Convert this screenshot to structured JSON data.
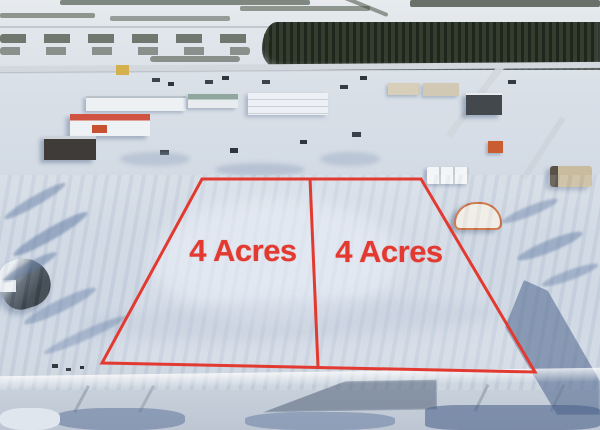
{
  "scene": {
    "type": "aerial-winter-photo",
    "description": "Drone photo of snowy rural industrial town with two marked land parcels",
    "accent_color": "#e23a30"
  },
  "parcels": {
    "left": {
      "label": "4 Acres"
    },
    "right": {
      "label": "4 Acres"
    }
  },
  "overlay": {
    "boundary_points": "202,179 421,179 535,372 102,363",
    "divider_points": "310,178 318,367",
    "stroke_width": "3"
  }
}
